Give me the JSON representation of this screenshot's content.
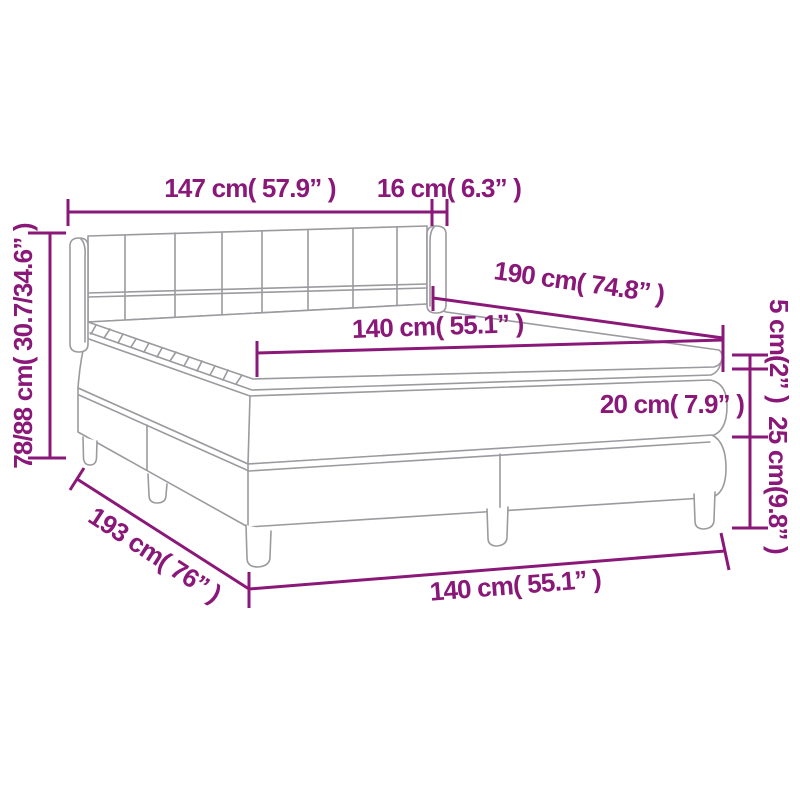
{
  "diagram": {
    "type": "product-dimension-diagram",
    "subject": "box spring bed with tufted headboard, mattress and topper",
    "colors": {
      "dimension_accent": "#8a1878",
      "line_art": "#9b9b9f",
      "background": "#ffffff"
    },
    "dimensions": {
      "headboard_width": "147 cm( 57.9” )",
      "wing_depth": "16 cm( 6.3” )",
      "headboard_height": "78/88 cm( 30.7/34.6” )",
      "mattress_length": "190 cm( 74.8” )",
      "mattress_width_top": "140 cm( 55.1” )",
      "topper_height": "5 cm(2” )",
      "mattress_height": "20 cm( 7.9” )",
      "base_height": "25 cm(9.8” )",
      "bed_length": "193 cm( 76” )",
      "bed_width_bottom": "140 cm( 55.1” )"
    }
  }
}
